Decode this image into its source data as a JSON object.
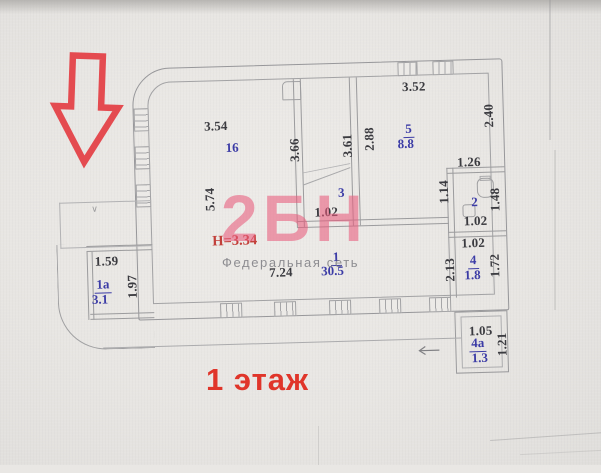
{
  "title": "1 этаж",
  "annotations": {
    "ceiling_height": "Н=3.34",
    "porch_mark": "∨"
  },
  "watermark": {
    "logo": "2БН",
    "subtitle": "Федеральная сеть"
  },
  "rooms": [
    {
      "number": "1",
      "area": "30.5"
    },
    {
      "number": "1а",
      "area": "3.1"
    },
    {
      "number": "2",
      "area": ""
    },
    {
      "number": "3",
      "area": ""
    },
    {
      "number": "4",
      "area": "1.8"
    },
    {
      "number": "4а",
      "area": "1.3"
    },
    {
      "number": "5",
      "area": "8.8"
    },
    {
      "number": "16",
      "area": ""
    }
  ],
  "dimensions": [
    {
      "value": "3.54"
    },
    {
      "value": "3.52"
    },
    {
      "value": "1.26"
    },
    {
      "value": "1.59"
    },
    {
      "value": "7.24"
    },
    {
      "value": "1.02"
    },
    {
      "value": "1.02"
    },
    {
      "value": "1.02"
    },
    {
      "value": "1.05"
    },
    {
      "value": "5.74"
    },
    {
      "value": "3.66"
    },
    {
      "value": "3.61"
    },
    {
      "value": "2.88"
    },
    {
      "value": "2.40"
    },
    {
      "value": "1.14"
    },
    {
      "value": "1.48"
    },
    {
      "value": "1.72"
    },
    {
      "value": "2.13"
    },
    {
      "value": "1.97"
    },
    {
      "value": "1.21"
    }
  ],
  "colors": {
    "accent_red": "#e0352a",
    "annotation_red": "#c2403a",
    "room_label_blue": "#3c3ca6",
    "watermark_pink": "#e85c7c",
    "line_gray": "#9b9b9d"
  }
}
